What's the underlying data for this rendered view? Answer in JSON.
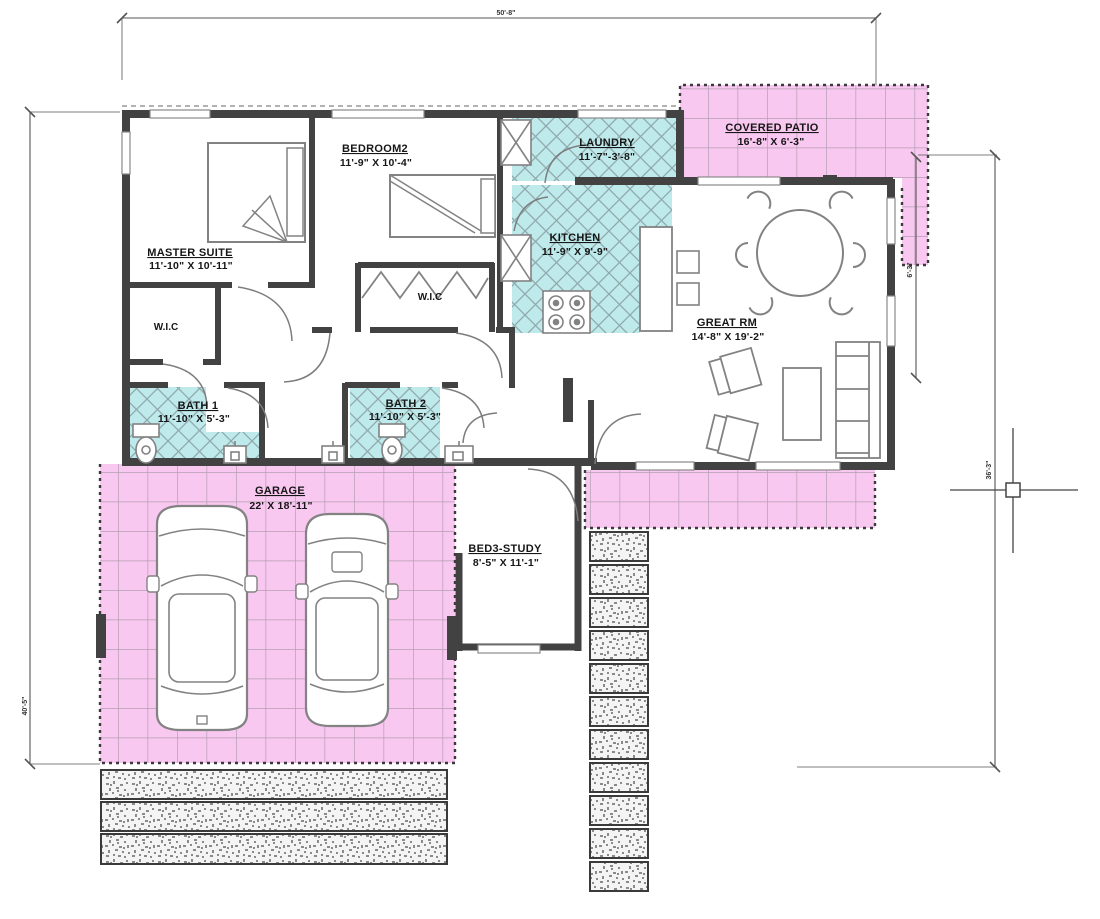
{
  "canvas": {
    "width": 1100,
    "height": 919,
    "type": "floor-plan CAD drawing"
  },
  "rooms": {
    "master_suite": {
      "name": "MASTER SUITE",
      "dims": "11'-10\" X 10'-11\""
    },
    "bedroom2": {
      "name": "BEDROOM2",
      "dims": "11'-9\" X 10'-4\""
    },
    "laundry": {
      "name": "LAUNDRY",
      "dims": "11'-7\"-3'-8\""
    },
    "covered_patio": {
      "name": "COVERED PATIO",
      "dims": "16'-8\" X 6'-3\""
    },
    "kitchen": {
      "name": "KITCHEN",
      "dims": "11'-9\" X 9'-9\""
    },
    "great_room": {
      "name": "GREAT RM",
      "dims": "14'-8\" X 19'-2\""
    },
    "wic_master": {
      "name": "W.I.C"
    },
    "wic_hall": {
      "name": "W.I.C"
    },
    "bath1": {
      "name": "BATH 1",
      "dims": "11'-10\" X 5'-3\""
    },
    "bath2": {
      "name": "BATH 2",
      "dims": "11'-10\" X 5'-3\""
    },
    "garage": {
      "name": "GARAGE",
      "dims": "22' X 18'-11\""
    },
    "bed3_study": {
      "name": "BED3-STUDY",
      "dims": "8'-5\" X 11'-1\""
    }
  },
  "dimension_labels": {
    "top": "50'-8\"",
    "left": "40'-5\"",
    "right": "36'-3\"",
    "patio_right": "6'-3\""
  },
  "colors": {
    "patio_pink": "#f9c8f0",
    "pink_grid_line": "#b49fb2",
    "tile_cyan": "#bfeaec",
    "cyan_hatch_line": "#8fa9ac",
    "wall_dark": "#424242",
    "furniture_line": "#828282",
    "dim_line": "#555555",
    "text": "#161616"
  }
}
